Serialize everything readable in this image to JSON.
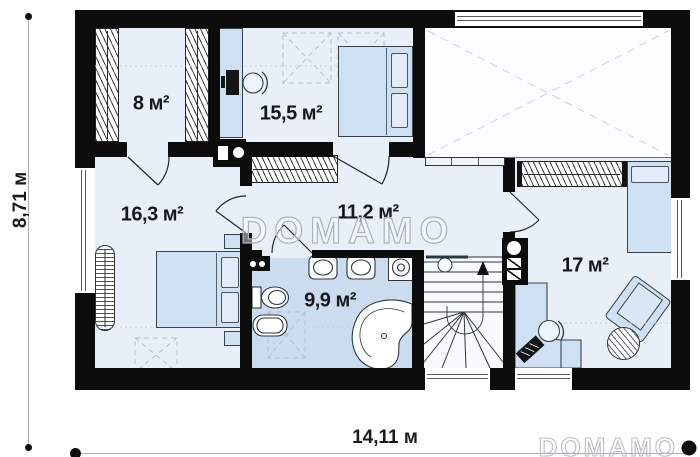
{
  "watermark": {
    "brand": "DOMAMO"
  },
  "dimensions": {
    "width_label": "14,11 м",
    "height_label": "8,71 м"
  },
  "rooms": {
    "closet": {
      "label": "8 м²"
    },
    "bedroom_top": {
      "label": "15,5 м²"
    },
    "bedroom_left": {
      "label": "16,3 м²"
    },
    "hall": {
      "label": "11,2 м²"
    },
    "bathroom": {
      "label": "9,9 м²"
    },
    "bedroom_right": {
      "label": "17 м²"
    }
  }
}
